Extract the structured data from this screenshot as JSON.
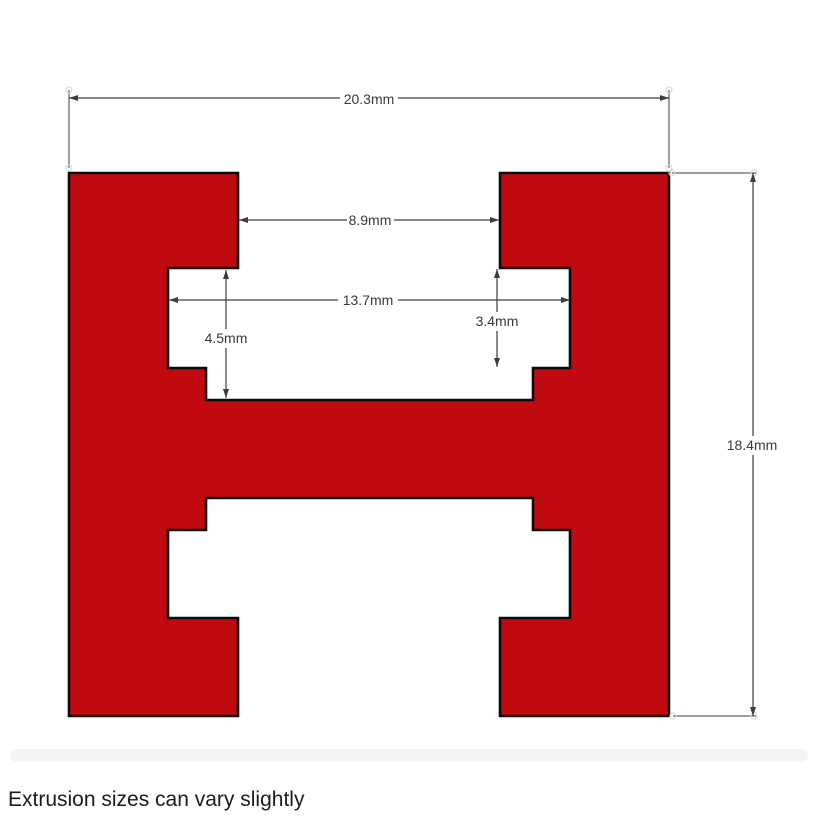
{
  "diagram": {
    "kind": "extrusion-cross-section-drawing",
    "profile_shape": "H-profile with inner lips and ledges",
    "dimensions": {
      "overall_width": "20.3mm",
      "top_slot_width": "8.9mm",
      "inner_cavity_width": "13.7mm",
      "cavity_depth": "4.5mm",
      "lip_step_height": "3.4mm",
      "overall_height": "18.4mm"
    },
    "note": "Extrusion sizes can vary slightly",
    "colors": {
      "profile_fill": "#c00a10",
      "profile_outline": "#0a0a0a",
      "dimension_line": "#3d3d3d",
      "note_band": "#f5f5f5"
    }
  }
}
